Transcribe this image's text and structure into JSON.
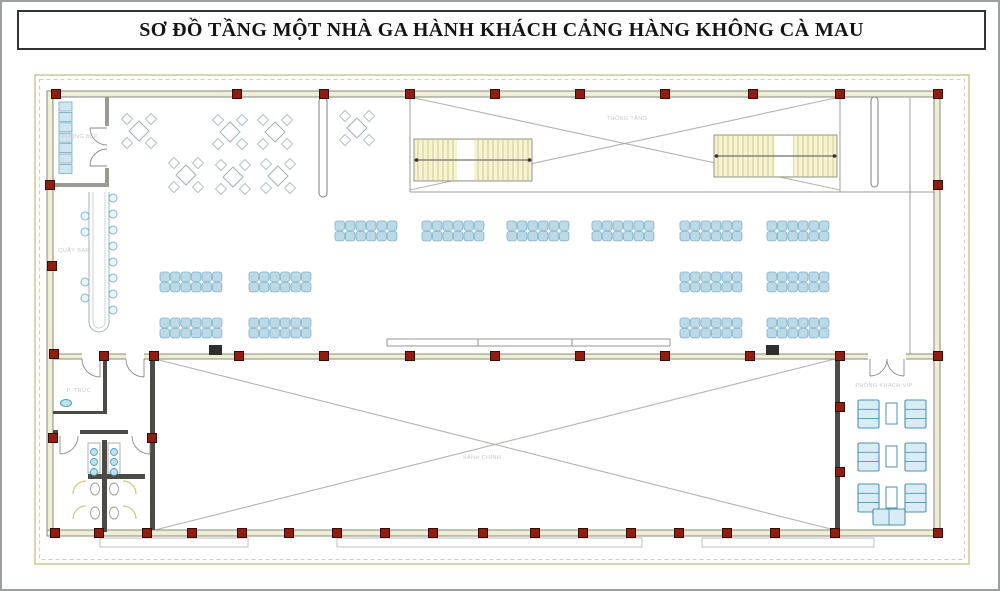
{
  "title": "SƠ ĐỒ TẦNG MỘT NHÀ GA HÀNH KHÁCH CẢNG HÀNG KHÔNG CÀ MAU",
  "plan": {
    "labels": {
      "upper_void": "THÔNG TẦNG",
      "main_hall": "SẢNH CHÍNH",
      "vip_room": "PHÒNG KHÁCH VIP",
      "kitchen_room": "PHÒNG BẾP",
      "bar_counter": "QUẦY BAR",
      "office_room": "P. TRỰC"
    },
    "colors": {
      "column_fill": "#8e1d12",
      "column_border": "#3c0a05",
      "wall_line": "#8a8a84",
      "wall_fill": "#efedd2",
      "dark_wall": "#4a4a46",
      "seat_fill": "#bcd9e8",
      "seat_border": "#7fb0c8",
      "stair_fill": "#f6f3cf",
      "stair_line": "#b5af78",
      "table_line": "#9fb0ba",
      "fixture_blue": "#4aa0c0",
      "fixture_blue_fill": "#bfe0ef",
      "cross_line": "#b3b3ad",
      "terrace_line": "#c9c48d",
      "door_arc": "#8a8a84",
      "stall_door": "#cfc77d",
      "sofa_line": "#4f93ad",
      "sofa_fill": "#d9ecf5"
    }
  }
}
